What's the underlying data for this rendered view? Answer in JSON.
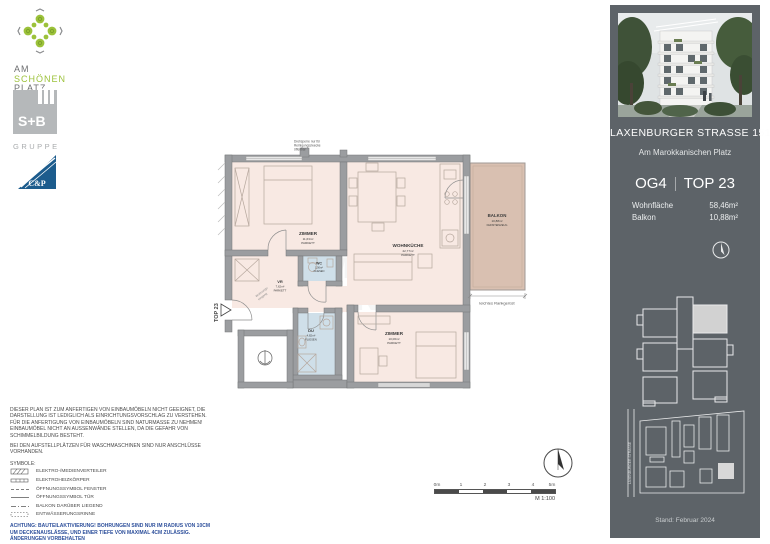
{
  "logos": {
    "asp_line1": "AM",
    "asp_line2": "SCHÖNEN",
    "asp_line3": "PLATZ",
    "sb_name": "S+B",
    "sb_sub": "GRUPPE",
    "cp_name": "C&P"
  },
  "plan": {
    "unit_tag": "TOP 23",
    "top_note": [
      "Drehsperre nur für",
      "Reinigungszwecke",
      "öffenbar"
    ],
    "entrance_note": [
      "Wohnungs-",
      "eingang"
    ],
    "trellis_note": "leichtes Rankgerüst",
    "watermark": [
      "IMMO",
      "KONTOR"
    ],
    "rooms": {
      "z1": {
        "name": "ZIMMER",
        "area": "11,63m²",
        "floor": "PARKETT"
      },
      "wk": {
        "name": "WOHNKÜCHE",
        "area": "22,77m²",
        "floor": "PARKETT"
      },
      "balkon": {
        "name": "BALKON",
        "area": "10,88m²",
        "floor": "FEINSTEINZEUG"
      },
      "wc": {
        "name": "WC",
        "area": "1,56m²",
        "floor": "FLIESEN"
      },
      "vr": {
        "name": "VR",
        "area": "7,62m²",
        "floor": "PARKETT"
      },
      "du": {
        "name": "DU",
        "area": "4,82m²",
        "floor": "FLIESEN"
      },
      "z2": {
        "name": "ZIMMER",
        "area": "10,06m²",
        "floor": "PARKETT"
      }
    }
  },
  "legal": {
    "paragraph1": "DIESER PLAN IST ZUM ANFERTIGEN VON EINBAUMÖBELN NICHT GEEIGNET, DIE DARSTELLUNG IST LEDIGLICH ALS EINRICHTUNGSVORSCHLAG ZU VERSTEHEN. FÜR DIE ANFERTIGUNG VON EINBAUMÖBELN SIND NATURMASSE ZU NEHMEN! EINBAUMÖBEL NICHT AN AUSSENWÄNDE STELLEN, DA DIE GEFAHR VON SCHIMMELBILDUNG BESTEHT.",
    "paragraph2": "BEI DEN AUFSTELLPLÄTZEN FÜR WASCHMASCHINEN SIND NUR ANSCHLÜSSE VORHANDEN.",
    "symbols_title": "SYMBOLE:",
    "symbols": [
      "ELEKTRO-/MEDIENVERTEILER",
      "ELEKTROHEIZKÖRPER",
      "ÖFFNUNGSSYMBOL FENSTER",
      "ÖFFNUNGSSYMBOL TÜR",
      "BALKON DARÜBER LIEGEND",
      "ENTWÄSSERUNGSRINNE"
    ],
    "warning": "ACHTUNG: BAUTEILAKTIVIERUNG! BOHRUNGEN SIND NUR IM RADIUS VON 10CM UM DECKENAUSLÄSSE, UND EINER TIEFE VON MAXIMAL 4CM ZULÄSSIG. ÄNDERUNGEN VORBEHALTEN"
  },
  "scale": {
    "ticks": [
      "0m",
      "1",
      "2",
      "3",
      "4",
      "5m"
    ],
    "ratio": "M 1:100"
  },
  "sidebar": {
    "address": "LAXENBURGER  STRASSE 151G",
    "subtitle": "Am Marokkanischen Platz",
    "floor": "OG4",
    "unit": "TOP 23",
    "metrics": [
      {
        "label": "Wohnfläche",
        "value": "58,46m²"
      },
      {
        "label": "Balkon",
        "value": "10,88m²"
      }
    ],
    "street_label": "LAXENBURGER STRASSE",
    "date": "Stand: Februar 2024"
  },
  "colors": {
    "sidebar_bg": "#5d6368",
    "room_fill": "#f8e9e3",
    "wet_room_fill": "#cfdfe9",
    "balcony_fill": "#d9c0b1",
    "wall": "#9b9da0",
    "brand_green": "#9cc23a",
    "brand_blue": "#1c5c8d",
    "warning_blue": "#2d4f9b"
  }
}
